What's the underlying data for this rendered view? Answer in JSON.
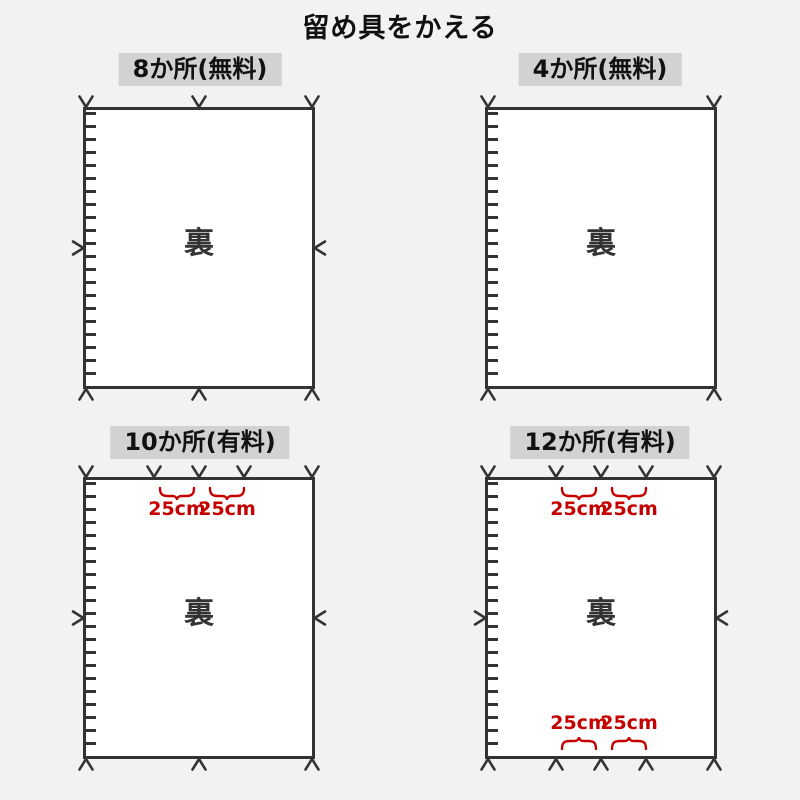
{
  "title": "留め具をかえる",
  "colors": {
    "background": "#f2f2f2",
    "panel_fill": "#ffffff",
    "outline": "#333333",
    "label_background": "#d2d2d2",
    "accent_red": "#c40000"
  },
  "panels": [
    {
      "id": "8-places-free",
      "label": "8か所(無料)",
      "back_label": "裏",
      "fastener_marks": {
        "top": 3,
        "bottom": 3,
        "left": 1,
        "right": 1
      }
    },
    {
      "id": "4-places-free",
      "label": "4か所(無料)",
      "back_label": "裏",
      "fastener_marks": {
        "top": 2,
        "bottom": 2,
        "left": 0,
        "right": 0
      }
    },
    {
      "id": "10-places-paid",
      "label": "10か所(有料)",
      "back_label": "裏",
      "fastener_marks": {
        "top": 5,
        "bottom": 3,
        "left": 1,
        "right": 1
      },
      "top_measurements": [
        "25cm",
        "25cm"
      ]
    },
    {
      "id": "12-places-paid",
      "label": "12か所(有料)",
      "back_label": "裏",
      "fastener_marks": {
        "top": 5,
        "bottom": 5,
        "left": 1,
        "right": 1
      },
      "top_measurements": [
        "25cm",
        "25cm"
      ],
      "bottom_measurements": [
        "25cm",
        "25cm"
      ]
    }
  ]
}
